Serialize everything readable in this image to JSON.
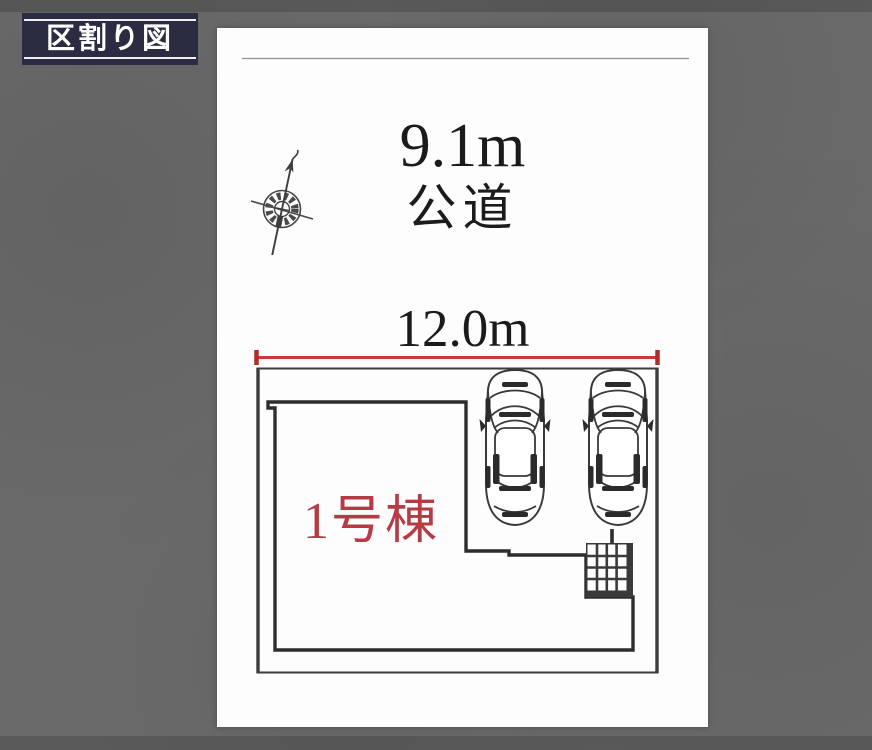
{
  "badge": {
    "label": "区割り図"
  },
  "plan": {
    "road": {
      "width": "9.1m",
      "name": "公道"
    },
    "frontage": {
      "width": "12.0m"
    },
    "building": {
      "name": "1号棟"
    }
  },
  "icons": {
    "compass": "north-compass",
    "car": "car-top-view",
    "storage": "storage-grid-hatch"
  },
  "colors": {
    "background": "#6b6a6b",
    "badge_bg": "#2b2b42",
    "badge_text": "#ffffff",
    "panel_bg": "#fdfdfd",
    "dim_red": "#c93a38",
    "building_label_red": "#b53b44",
    "line_dark": "#2e2e2e"
  }
}
